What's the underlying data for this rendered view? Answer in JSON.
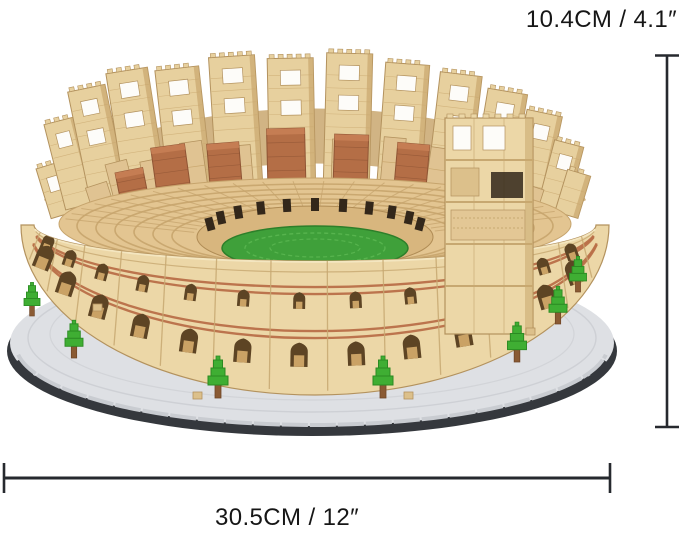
{
  "dimensions": {
    "height": {
      "label": "10.4CM / 4.1″"
    },
    "width": {
      "label": "30.5CM / 12″"
    }
  },
  "model": {
    "subject": "Colosseum micro building-block model on stepped display base with trees"
  },
  "colors": {
    "background": "#ffffff",
    "dim_line": "#26292e",
    "label_text": "#161616",
    "wall_face": "#ecd7a7",
    "wall_light": "#f4e6c0",
    "wall_edge": "#b3925e",
    "wall_seam": "#c7a871",
    "ruin_face": "#e7d09e",
    "ruin_shadow": "#c9a76e",
    "stripe": "#b96f48",
    "arch_dark": "#5d4424",
    "arch_inner": "#caa265",
    "brick": "#b46e46",
    "brick_dark": "#8f5434",
    "brick_top": "#c57d53",
    "seat": "#e3c591",
    "seat_line": "#c6a46d",
    "inner_band": "#d8b67e",
    "opening": "#33271a",
    "arena": "#3fa03a",
    "arena_dark": "#2d7f2a",
    "arena_light": "#57b44e",
    "tree": "#3fae33",
    "tree_dark": "#2b8a22",
    "trunk": "#8a5a33",
    "base_top": "#dee0e4",
    "base_mid": "#c9ccd1",
    "base_dark": "#35383d",
    "block_tan": "#dcc08b",
    "hole_white": "#fdfcf9"
  }
}
